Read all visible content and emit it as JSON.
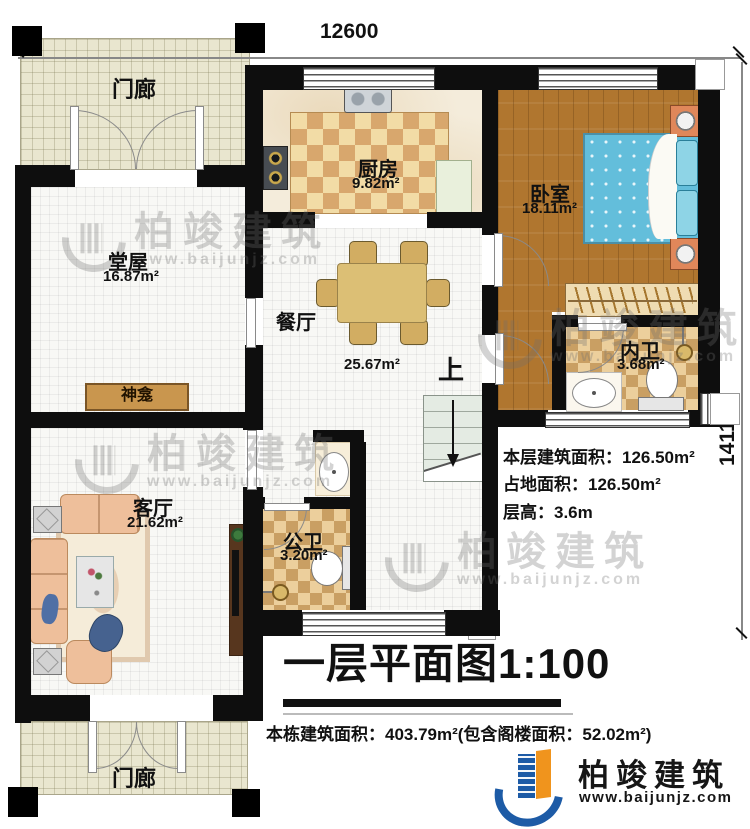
{
  "dimensions": {
    "top": "12600",
    "right": "14110"
  },
  "rooms": {
    "porch_top": {
      "name": "门廊"
    },
    "kitchen": {
      "name": "厨房",
      "area": "9.82m²"
    },
    "bedroom": {
      "name": "卧室",
      "area": "18.11m²"
    },
    "tangwu": {
      "name": "堂屋",
      "area": "16.87m²"
    },
    "dining": {
      "name": "餐厅",
      "area": "25.67m²"
    },
    "inner_bath": {
      "name": "内卫",
      "area": "3.68m²"
    },
    "living": {
      "name": "客厅",
      "area": "21.62m²"
    },
    "public_bath": {
      "name": "公卫",
      "area": "3.20m²"
    },
    "porch_bottom": {
      "name": "门廊"
    }
  },
  "plan_labels": {
    "shrine": "神龛",
    "stairs_up": "上"
  },
  "info": {
    "floor_area": "本层建筑面积：126.50m²",
    "land_area": "占地面积：126.50m²",
    "floor_height": "层高：3.6m"
  },
  "title": {
    "text": "一层平面图1:100"
  },
  "footer": {
    "text": "本栋建筑面积：403.79m²(包含阁楼面积：52.02m²)"
  },
  "logo": {
    "brand": "柏竣建筑",
    "url": "www.baijunjz.com"
  },
  "watermark": {
    "brand": "柏竣建筑",
    "url": "www.baijunjz.com"
  },
  "colors": {
    "wall": "#0e0e0e",
    "wood": "#b0762f",
    "porch": "#e9e6cf",
    "rug_dark": "#d8a76d",
    "rug_light": "#f2dca6",
    "bed": "#63bedb",
    "brand_blue": "#1d5ba6",
    "brand_orange": "#f0941d"
  }
}
